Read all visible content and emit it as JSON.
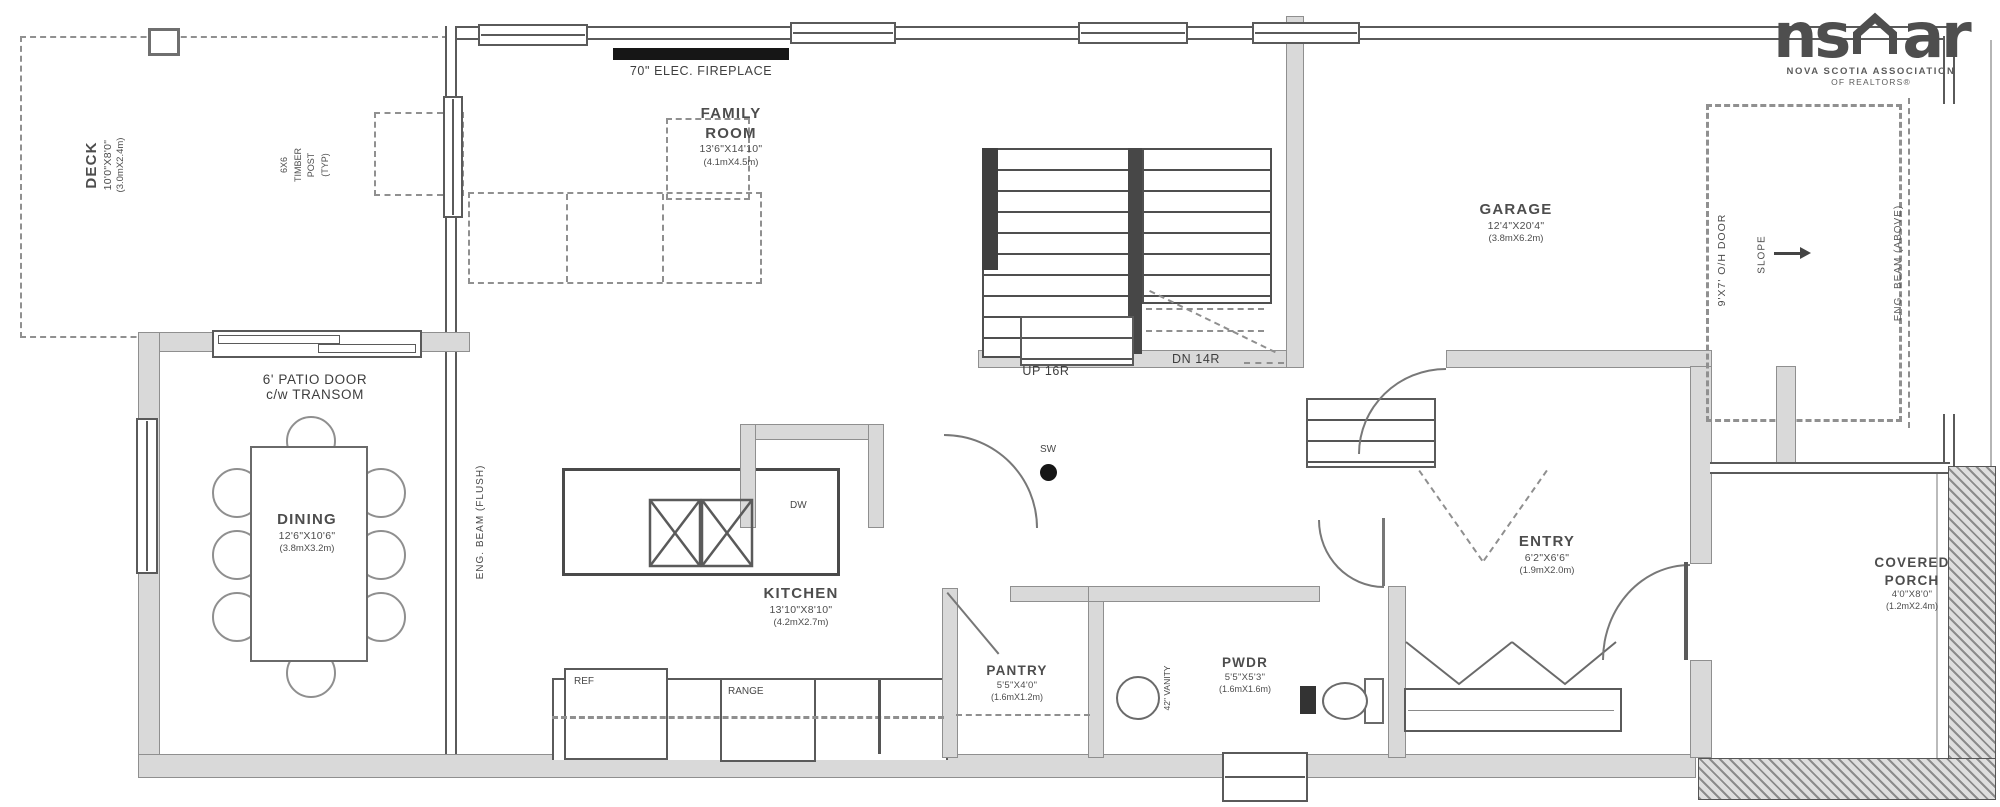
{
  "colors": {
    "wall_fill": "#d9d9d9",
    "line": "#4f4f4f",
    "fireplace": "#161616"
  },
  "logo": {
    "ns": "ns",
    "ar": "ar",
    "assoc": "NOVA SCOTIA ASSOCIATION",
    "realtors": "OF REALTORS®"
  },
  "rooms": {
    "deck": {
      "name": "DECK",
      "dims": "10'0\"X8'0\"",
      "metric": "(3.0mX2.4m)"
    },
    "family": {
      "line1": "FAMILY",
      "line2": "ROOM",
      "dims": "13'6\"X14'10\"",
      "metric": "(4.1mX4.5m)"
    },
    "dining": {
      "name": "DINING",
      "dims": "12'6\"X10'6\"",
      "metric": "(3.8mX3.2m)"
    },
    "kitchen": {
      "name": "KITCHEN",
      "dims": "13'10\"X8'10\"",
      "metric": "(4.2mX2.7m)"
    },
    "pantry": {
      "name": "PANTRY",
      "dims": "5'5\"X4'0\"",
      "metric": "(1.6mX1.2m)"
    },
    "pwdr": {
      "name": "PWDR",
      "dims": "5'5\"X5'3\"",
      "metric": "(1.6mX1.6m)"
    },
    "entry": {
      "name": "ENTRY",
      "dims": "6'2\"X6'6\"",
      "metric": "(1.9mX2.0m)"
    },
    "garage": {
      "name": "GARAGE",
      "dims": "12'4\"X20'4\"",
      "metric": "(3.8mX6.2m)"
    },
    "porch": {
      "line1": "COVERED",
      "line2": "PORCH",
      "dims": "4'0\"X8'0\"",
      "metric": "(1.2mX2.4m)"
    }
  },
  "deck_note": {
    "l1": "6X6",
    "l2": "TIMBER",
    "l3": "POST",
    "l4": "(TYP)"
  },
  "annotations": {
    "fireplace": "70\" ELEC. FIREPLACE",
    "patio_line1": "6' PATIO DOOR",
    "patio_line2": "c/w TRANSOM",
    "stairs_up": "UP 16R",
    "stairs_dn": "DN 14R",
    "switch": "SW",
    "fridge": "REF",
    "range": "RANGE",
    "dishwasher": "DW",
    "vanity": "42\" VANITY",
    "overhead_door": "9'X7' O/H DOOR",
    "slope": "SLOPE",
    "beam_flush": "ENG. BEAM (FLUSH)",
    "beam_above": "ENG. BEAM (ABOVE)"
  }
}
